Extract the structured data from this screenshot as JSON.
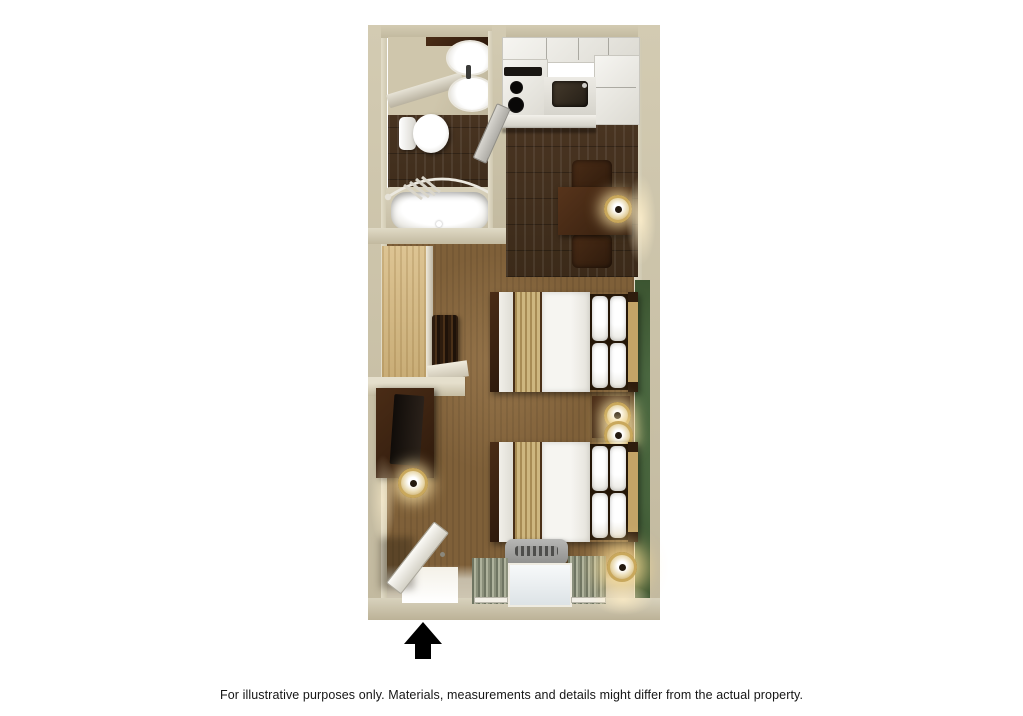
{
  "caption": {
    "text": "For illustrative purposes only.  Materials, measurements and details might differ from the actual property."
  },
  "floorplan": {
    "type": "hotel-studio-suite-top-down-3d-rendering",
    "icons": {
      "entrance_arrow_icon": "solid black upward arrow marking the room entrance"
    },
    "features": [
      "bathroom with vanity sink, mirror, toilet and bathtub with curved shower rod and towels",
      "kitchenette with white cabinets, stove with two burners, sink and counter/refrigerator",
      "dining table with two chairs and table lamp",
      "closet with shelving and hanging clothes",
      "dresser with television and lamp",
      "two double beds with white bedding, tan foot runners and wood headboards",
      "nightstand with lamp between beds",
      "green accent wall behind headboards",
      "entry door shown open",
      "window with striped curtains and air-conditioning unit",
      "floor lamp in corner"
    ],
    "palette": {
      "outer_wall_tan": "#c8bfa5",
      "wall_face_light": "#e0dac6",
      "dark_wood_floor": "#42301e",
      "carpet_brown": "#8a6b44",
      "accent_wall_green": "#46623b",
      "bedding_white": "#f3f2ee",
      "bed_runner_tan": "#cdb67f",
      "furniture_dark_brown": "#3a2513",
      "closet_wood_light": "#d7bd8c",
      "cabinet_white": "#efeeea",
      "ac_unit_grey": "#a3a3a1",
      "lamp_gold": "#c9a85c",
      "arrow_black": "#000000"
    }
  }
}
